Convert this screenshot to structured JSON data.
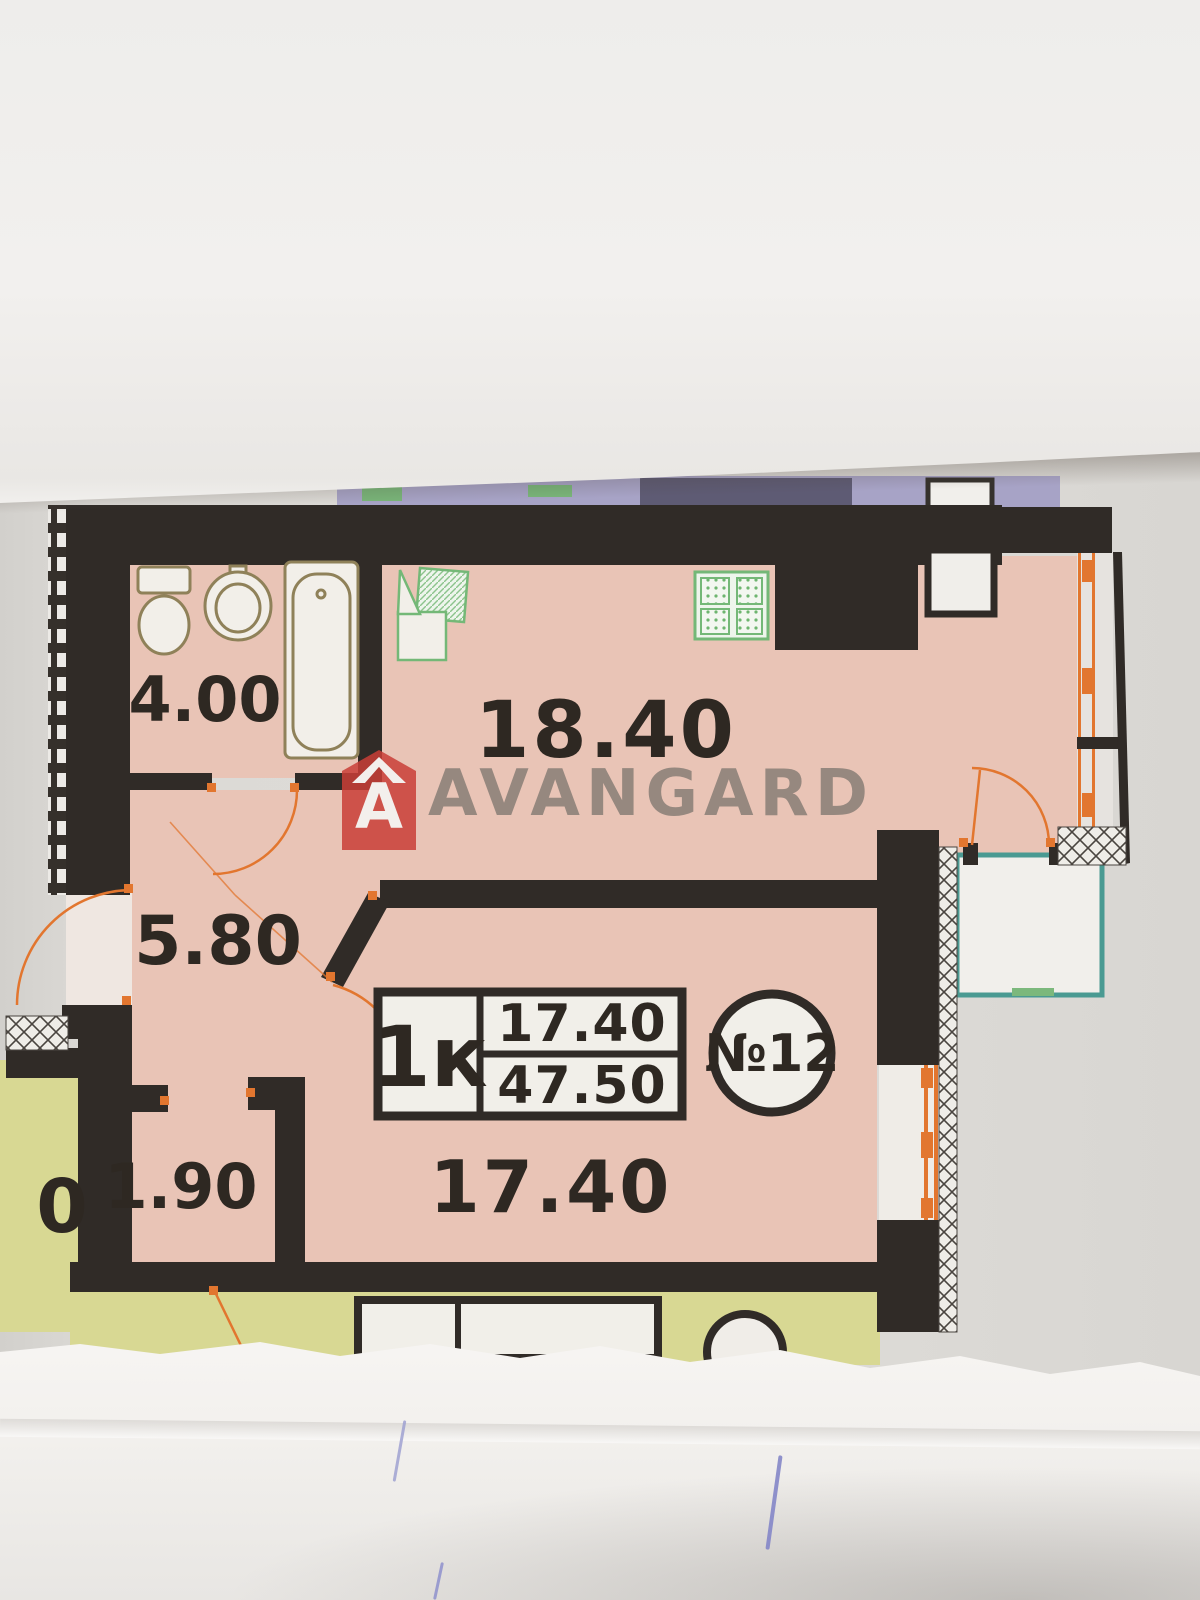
{
  "plan": {
    "watermark": {
      "brand": "AVANGARD",
      "logo_letter": "A"
    },
    "rooms": [
      {
        "name": "bathroom",
        "area": "4.00"
      },
      {
        "name": "living-kitchen",
        "area": "18.40"
      },
      {
        "name": "hallway",
        "area": "5.80"
      },
      {
        "name": "storage",
        "area": "1.90"
      },
      {
        "name": "bedroom",
        "area": "17.40"
      }
    ],
    "info_box": {
      "type_label": "1к",
      "room_area": "17.40",
      "total_area": "47.50",
      "unit_number": "№12"
    },
    "adjacent_apartment": {
      "partial_area_digit": "0"
    },
    "colors": {
      "wall": "#302b27",
      "pink": "#e9c4b6",
      "yellow": "#d8d893",
      "teal": "#4a9a92",
      "orange": "#e2762f",
      "green": "#74b877",
      "purple": "#a7a3c6",
      "ink": "#2e2822"
    }
  }
}
